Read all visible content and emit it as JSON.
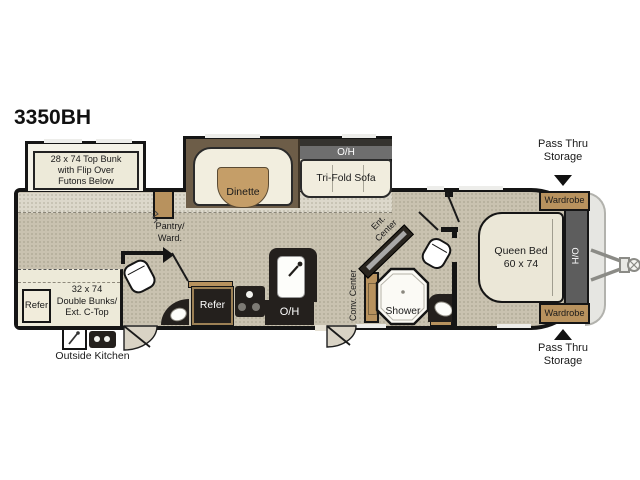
{
  "title": "3350BH",
  "palette": {
    "floor": "#c9c2b0",
    "slide_floor": "#dcd8cb",
    "cream": "#edead9",
    "wood": "#b8925e",
    "dark_cabinet": "#24201d",
    "wall": "#151515",
    "overhead_gray": "#6e6e6e",
    "front_overhead_gray": "#5d5d5d"
  },
  "exterior": {
    "pass_thru_top": "Pass Thru\nStorage",
    "pass_thru_bottom": "Pass Thru\nStorage",
    "outside_kitchen": "Outside Kitchen"
  },
  "bunk_room": {
    "top_bunk": "28 x 74 Top Bunk\nwith Flip Over\nFutons Below",
    "double_bunks": "32 x 74\nDouble Bunks/\nExt. C-Top",
    "refer": "Refer"
  },
  "living": {
    "dinette": "Dinette",
    "sofa_overhead": "O/H",
    "trifold_sofa": "Tri-Fold Sofa",
    "pantry": "Pantry/\nWard.",
    "ent_center": "Ent.\nCenter"
  },
  "kitchen": {
    "refer": "Refer",
    "overhead": "O/H",
    "conv_center": "Conv. Center"
  },
  "bathroom": {
    "shower": "Shower"
  },
  "bedroom": {
    "queen_bed": "Queen Bed\n60 x 74",
    "overhead": "H/O",
    "wardrobe_top": "Wardrobe",
    "wardrobe_bottom": "Wardrobe"
  }
}
